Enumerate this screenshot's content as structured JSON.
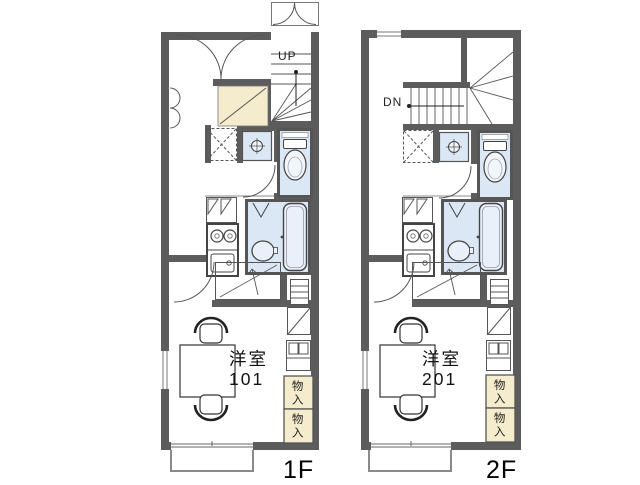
{
  "document_type": "apartment-floor-plan",
  "colors": {
    "wall": "#5c5c5c",
    "fixture_blue": "#dbe7f4",
    "fixture_blue_light": "#eef3fa",
    "storage_beige": "#f5ebcd",
    "line": "#555555",
    "text": "#1a1a1a",
    "background": "#ffffff"
  },
  "icons": {
    "staircase-up": "fan-and-tread-lines",
    "staircase-down": "fan-and-tread-lines",
    "entrance-door": "double-swing-arcs",
    "toilet": "tank-and-bowl",
    "washbasin": "square-with-cross-circle",
    "washing-machine": "dashed-square-x",
    "refrigerator": "square-with-triangles",
    "kitchen-stove": "two-burner-circles",
    "kitchen-sink": "rounded-rect-drain",
    "bathtub": "rounded-tub",
    "table": "rectangle",
    "chair": "arc-back-seat",
    "ladder": "runged-rect",
    "balcony": "open-rectangle"
  },
  "floors": [
    {
      "id": "1f",
      "floor_label": "1F",
      "stair_label": "UP",
      "room_name": "洋室",
      "room_number": "101",
      "storage_labels": [
        "物入",
        "物入"
      ]
    },
    {
      "id": "2f",
      "floor_label": "2F",
      "stair_label": "DN",
      "room_name": "洋室",
      "room_number": "201",
      "storage_labels": [
        "物入",
        "物入"
      ]
    }
  ]
}
